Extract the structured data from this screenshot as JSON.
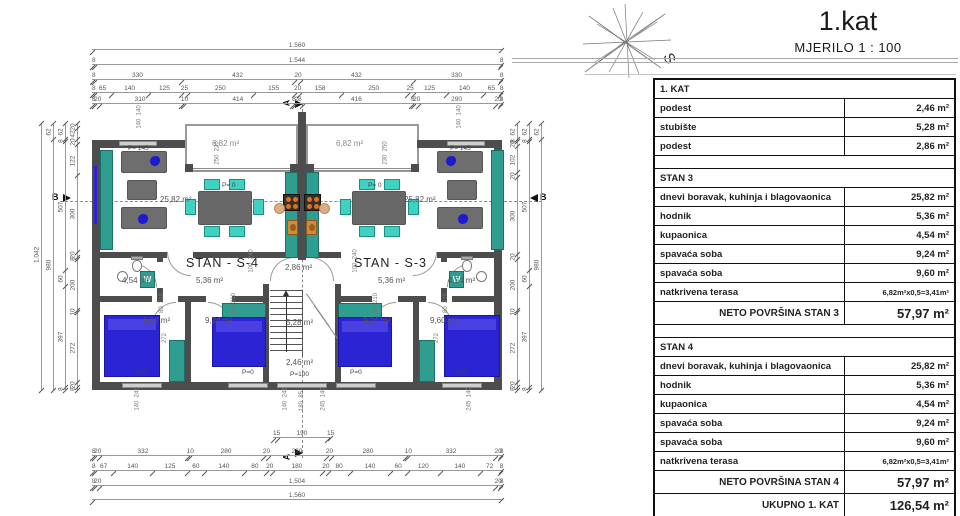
{
  "title": {
    "main": "1.kat",
    "scale": "MJERILO 1 : 100"
  },
  "markers": {
    "a": "A",
    "b": "B",
    "s": "S"
  },
  "plan": {
    "labels": {
      "terrace": "6,82 m²",
      "living": "25,82 m²",
      "landing_top": "2,86 m²",
      "stairs": "5,28 m²",
      "landing_bot": "2,46 m²",
      "bed_big": "9,60 m²",
      "bed_small": "9,24 m²",
      "bath": "4,54 m²",
      "hall": "5,36 m²",
      "unit_left": "STAN - S-4",
      "unit_right": "STAN - S-3",
      "p145": "P= 145",
      "p0": "P= 0",
      "p0w": "P=0",
      "p100": "P=100",
      "washer": "W"
    },
    "rot": {
      "win_top": "140  140",
      "terr_door": "250  230",
      "terr_door_r": "230  250",
      "bed_h": "272",
      "win_bot": "140  245",
      "win_bot_m": "245  140",
      "entry": "180  85",
      "door_landing": "100  240",
      "door_bed": "80  210"
    },
    "dims": {
      "top": [
        [
          "1.560"
        ],
        [
          "8",
          "1.544",
          "8"
        ],
        [
          "8",
          "330",
          "432",
          "20",
          "432",
          "330",
          "8"
        ],
        [
          "8",
          "65",
          "140",
          "125",
          "25",
          "250",
          "155",
          "20",
          "158",
          "250",
          "25",
          "125",
          "140",
          "65",
          "8"
        ],
        [
          "8",
          "20",
          "310",
          "10",
          "414",
          "8",
          "28",
          "416",
          "8",
          "20",
          "290",
          "20",
          "8"
        ]
      ],
      "bottom": [
        [
          "15",
          "190",
          "15"
        ],
        [
          "8",
          "20",
          "332",
          "10",
          "280",
          "20",
          "220",
          "20",
          "280",
          "10",
          "332",
          "20",
          "8"
        ],
        [
          "8",
          "67",
          "140",
          "125",
          "60",
          "140",
          "80",
          "20",
          "180",
          "20",
          "80",
          "140",
          "60",
          "120",
          "140",
          "72",
          "8"
        ],
        [
          "8",
          "20",
          "1.504",
          "20",
          "8"
        ],
        [
          "1.560"
        ]
      ],
      "left": [
        [
          "1.042"
        ],
        [
          "62",
          "980"
        ],
        [
          "62",
          "8",
          "507",
          "60",
          "397",
          "8"
        ],
        [
          "20",
          "42",
          "20",
          "122",
          "300",
          "20",
          "8",
          "200",
          "10",
          "272",
          "20",
          "8"
        ]
      ],
      "right": [
        [
          "62",
          "8",
          "20",
          "102",
          "20",
          "300",
          "20",
          "200",
          "10",
          "272",
          "20",
          "8"
        ],
        [
          "62",
          "8",
          "507",
          "60",
          "397",
          "8"
        ],
        [
          "62",
          "980"
        ]
      ]
    }
  },
  "table": {
    "rows": [
      {
        "t": "head",
        "label": "1. KAT",
        "value": ""
      },
      {
        "t": "row",
        "label": "podest",
        "value": "2,46 m²"
      },
      {
        "t": "row",
        "label": "stubište",
        "value": "5,28 m²"
      },
      {
        "t": "row",
        "label": "podest",
        "value": "2,86 m²"
      },
      {
        "t": "gap",
        "label": "",
        "value": ""
      },
      {
        "t": "head",
        "label": "STAN 3",
        "value": ""
      },
      {
        "t": "row",
        "label": "dnevi boravak, kuhinja i blagovaonica",
        "value": "25,82 m²"
      },
      {
        "t": "row",
        "label": "hodnik",
        "value": "5,36 m²"
      },
      {
        "t": "row",
        "label": "kupaonica",
        "value": "4,54 m²"
      },
      {
        "t": "row",
        "label": "spavaća soba",
        "value": "9,24 m²"
      },
      {
        "t": "row",
        "label": "spavaća soba",
        "value": "9,60 m²"
      },
      {
        "t": "row",
        "label": "natkrivena terasa",
        "value": "6,82m²x0,5=3,41m²"
      },
      {
        "t": "big",
        "label": "NETO POVRŠINA STAN 3",
        "value": "57,97 m²"
      },
      {
        "t": "gap",
        "label": "",
        "value": ""
      },
      {
        "t": "head",
        "label": "STAN 4",
        "value": ""
      },
      {
        "t": "row",
        "label": "dnevi boravak, kuhinja i blagovaonica",
        "value": "25,82 m²"
      },
      {
        "t": "row",
        "label": "hodnik",
        "value": "5,36 m²"
      },
      {
        "t": "row",
        "label": "kupaonica",
        "value": "4,54 m²"
      },
      {
        "t": "row",
        "label": "spavaća soba",
        "value": "9,24 m²"
      },
      {
        "t": "row",
        "label": "spavaća soba",
        "value": "9,60 m²"
      },
      {
        "t": "row",
        "label": "natkrivena terasa",
        "value": "6,82m²x0,5=3,41m²"
      },
      {
        "t": "big",
        "label": "NETO POVRŠINA STAN 4",
        "value": "57,97 m²"
      },
      {
        "t": "big",
        "label": "UKUPNO 1. KAT",
        "value": "126,54 m²"
      }
    ]
  }
}
